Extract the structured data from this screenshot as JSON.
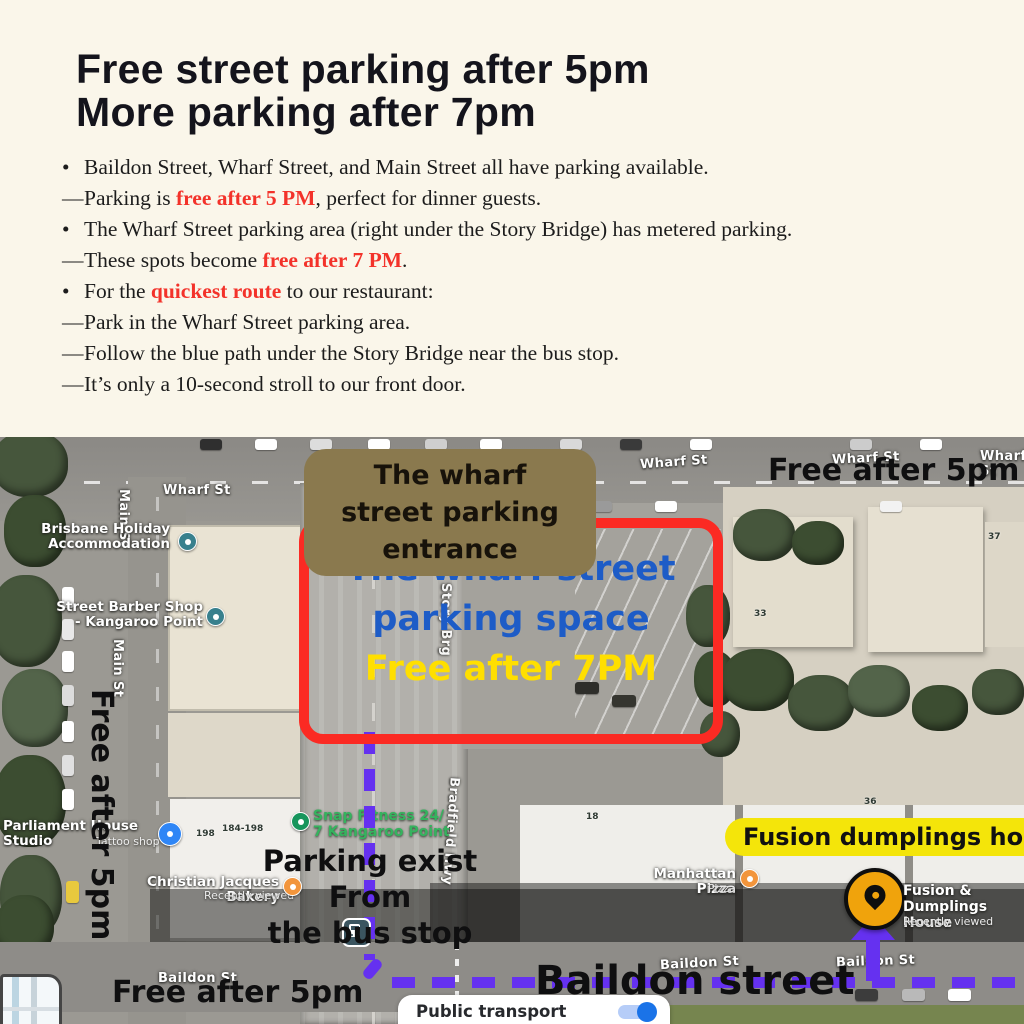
{
  "colors": {
    "background_cream": "#faf6ea",
    "accent_red": "#f3322a",
    "badge_brown": "#8a794e",
    "box_red": "#fb2a23",
    "text_blue": "#1d5cc7",
    "text_yellow": "#ffdf00",
    "badge_yellow": "#f4e50a",
    "route_purple": "#6531f0",
    "marker_orange": "#f0a30c",
    "toggle_blue": "#1a73e8"
  },
  "header": {
    "title_line1": "Free street parking after 5pm",
    "title_line2": "More parking after 7pm",
    "bullets": [
      {
        "marker": "•",
        "segments": [
          {
            "text": "Baildon Street, Wharf Street, and Main Street all have parking available."
          }
        ]
      },
      {
        "marker": "—",
        "segments": [
          {
            "text": "Parking is "
          },
          {
            "text": "free after 5 PM",
            "accent": true
          },
          {
            "text": ", perfect for dinner guests."
          }
        ]
      },
      {
        "marker": "•",
        "segments": [
          {
            "text": "The Wharf Street parking area (right under the Story Bridge) has metered parking."
          }
        ]
      },
      {
        "marker": "—",
        "segments": [
          {
            "text": "These spots become "
          },
          {
            "text": "free after 7 PM",
            "accent": true
          },
          {
            "text": "."
          }
        ]
      },
      {
        "marker": "•",
        "segments": [
          {
            "text": "For the "
          },
          {
            "text": "quickest route",
            "accent": true
          },
          {
            "text": " to our restaurant:"
          }
        ]
      },
      {
        "marker": "—",
        "segments": [
          {
            "text": "Park in the Wharf Street parking area."
          }
        ]
      },
      {
        "marker": "—",
        "segments": [
          {
            "text": "Follow the blue path under the Story Bridge near the bus stop."
          }
        ]
      },
      {
        "marker": "—",
        "segments": [
          {
            "text": "It’s only a 10-second stroll to our front door."
          }
        ]
      }
    ]
  },
  "map": {
    "entrance_badge": "The wharf street parking entrance",
    "parking_space_line1": "The wharf street",
    "parking_space_line2": "parking space",
    "parking_space_free": "Free after 7PM",
    "free_after_5pm_top": "Free after 5pm",
    "free_after_5pm_left": "Free after 5pm",
    "free_after_5pm_bottom": "Free after 5pm",
    "parking_exit_line1": "Parking exist From",
    "parking_exit_line2": "the bus stop",
    "baildon_street_annotation": "Baildon street",
    "fusion_badge": "Fusion dumplings house",
    "streets": {
      "wharf_st": "Wharf St",
      "main_st": "Main St",
      "baildon_st": "Baildon St",
      "bradfield_hwy": "Bradfield Hwy",
      "story_brg": "Story Brg"
    },
    "pois": {
      "brisbane_holiday": "Brisbane Holiday\nAccommodation",
      "street_barber": "Street Barber Shop\n- Kangaroo Point",
      "parliament": "Parliament House Studio",
      "tattoo": "Tattoo shop",
      "bakery": "Christian Jacques Bakery",
      "bakery_sub": "Recently viewed",
      "snap_fitness": "Snap Fitness 24/\n7 Kangaroo Point",
      "manhattan": "Manhattan Pizza",
      "manhattan_sub": "Pizza",
      "fusion": "Fusion &\nDumplings House",
      "fusion_sub": "Recently viewed"
    },
    "building_numbers": {
      "a": "198",
      "b": "184-198",
      "c": "18",
      "d": "33",
      "e": "37",
      "f": "36"
    },
    "controls": {
      "public_transport_label": "Public transport",
      "public_transport_on": true
    }
  }
}
